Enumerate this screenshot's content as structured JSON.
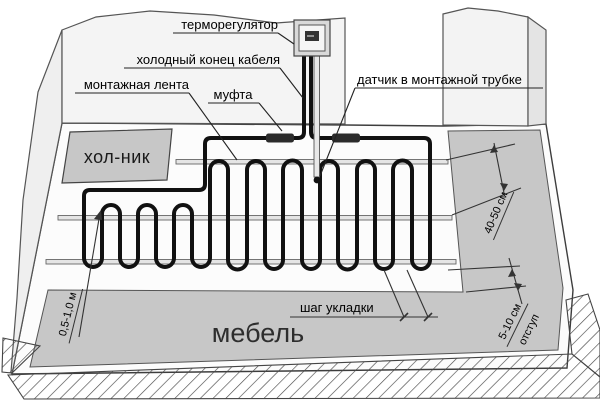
{
  "diagram": {
    "labels": {
      "thermostat": "терморегулятор",
      "cold_end": "холодный конец кабеля",
      "mounting_tape": "монтажная лента",
      "coupling": "муфта",
      "sensor": "датчик в монтажной трубке"
    },
    "areas": {
      "fridge": "хол-ник",
      "furniture": "мебель"
    },
    "dimensions": {
      "laying_step": "шаг укладки",
      "tape_spacing": "40-50 см",
      "edge_offset_value": "5-10 см",
      "edge_offset_word": "отступ",
      "wall_clearance": "0,5-1,0 м"
    },
    "colors": {
      "area_gray": "#c7c7c7",
      "wall_gray": "#f3f3f3",
      "floor_white": "#fcfcfc",
      "cable_black": "#111111",
      "tape_gray": "#e5e5e5",
      "coupling_dark": "#2b2b2b",
      "line_dark": "#333333"
    }
  }
}
